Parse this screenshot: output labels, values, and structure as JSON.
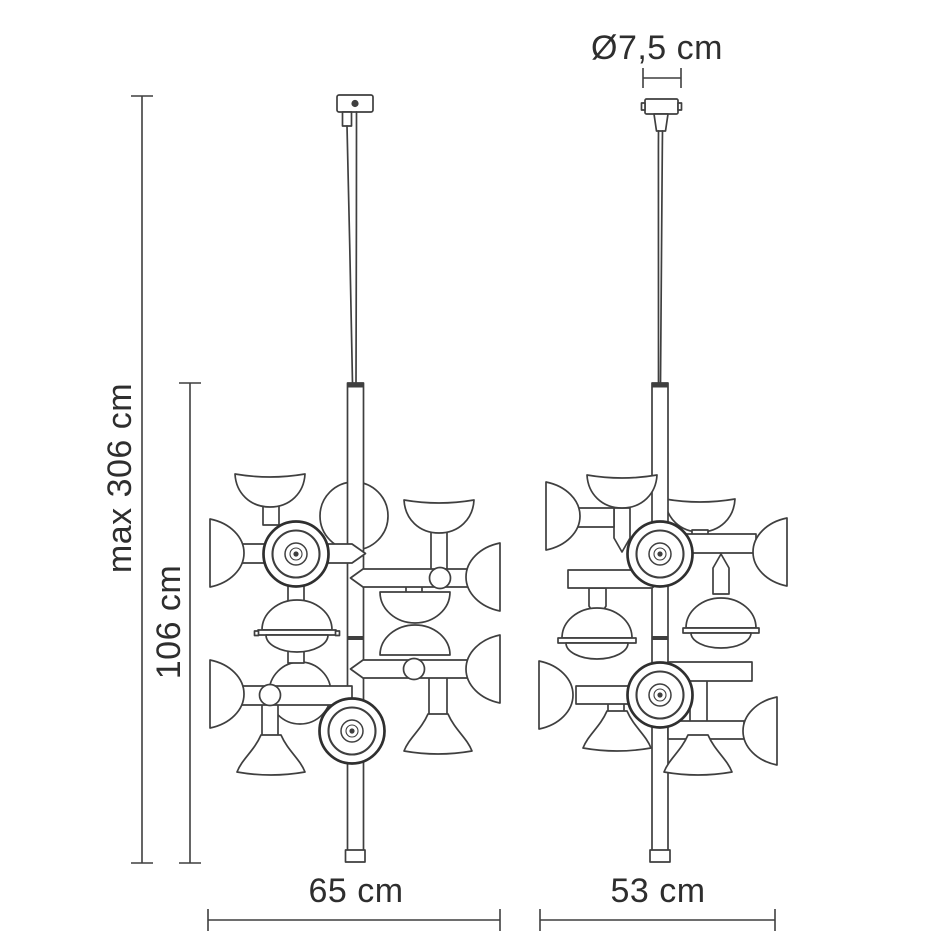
{
  "diagram": {
    "colors": {
      "background": "#ffffff",
      "line": "#3f3f3f",
      "text": "#2e2e2e"
    },
    "views": {
      "front": {
        "name": "front-view",
        "width_label": "65 cm"
      },
      "side": {
        "name": "side-view",
        "width_label": "53 cm"
      }
    },
    "labels": {
      "max_height": "max 306 cm",
      "fixture_height": "106 cm",
      "front_width": "65 cm",
      "side_width": "53 cm",
      "canopy_diameter": "Ø7,5 cm"
    }
  }
}
